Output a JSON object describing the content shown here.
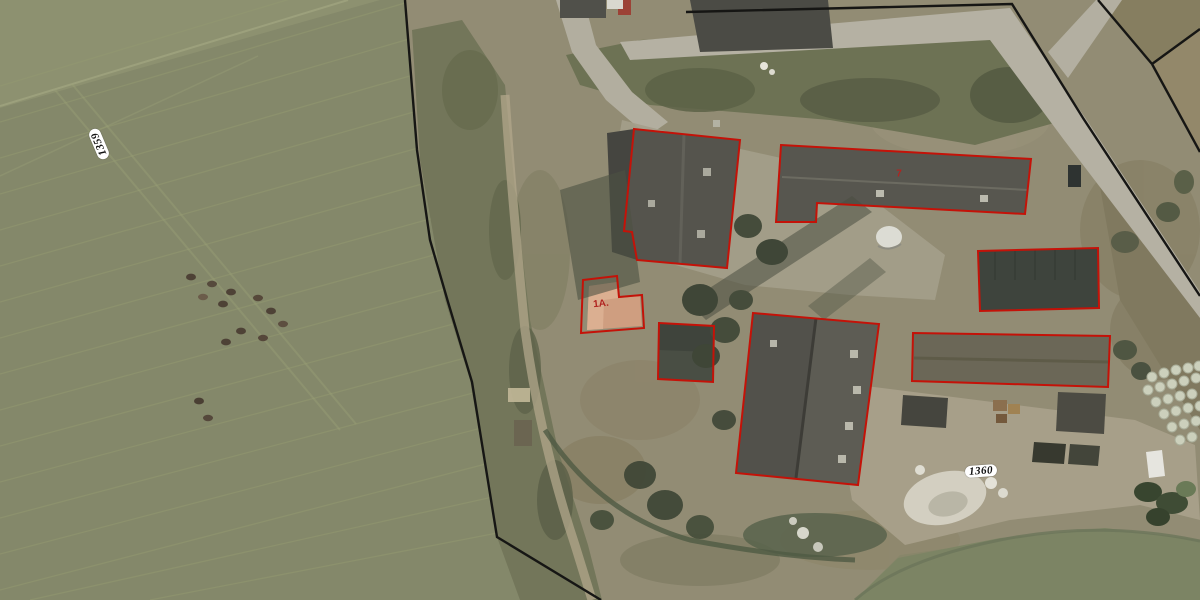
{
  "map": {
    "type": "aerial-cadastral-view",
    "labels": {
      "parcel_left": {
        "text": "1359",
        "x": 99,
        "y": 144,
        "rotation": -113
      },
      "parcel_right": {
        "text": "1360",
        "x": 981,
        "y": 471,
        "rotation": -4
      },
      "house_number_1a": {
        "text": "1A.",
        "x": 601,
        "y": 304,
        "rotation": -6
      },
      "house_number_7": {
        "text": "7",
        "x": 899,
        "y": 174,
        "rotation": 0
      }
    },
    "overlay": {
      "outline_color": "#c41208",
      "boundary_color": "#161614",
      "label_text_color": "#b02420",
      "boundary_lines": [
        {
          "name": "parcel-boundary-west",
          "points": [
            [
              405,
              0
            ],
            [
              417,
              150
            ],
            [
              430,
              240
            ],
            [
              448,
              302
            ],
            [
              472,
              382
            ],
            [
              497,
              537
            ],
            [
              601,
              600
            ]
          ]
        },
        {
          "name": "parcel-boundary-north-east",
          "points": [
            [
              686,
              12
            ],
            [
              1012,
              4
            ],
            [
              1083,
              118
            ],
            [
              1200,
              296
            ]
          ]
        },
        {
          "name": "neighbor-boundary-a",
          "points": [
            [
              1098,
              0
            ],
            [
              1152,
              64
            ]
          ]
        },
        {
          "name": "neighbor-boundary-b",
          "points": [
            [
              1152,
              64
            ],
            [
              1200,
              29
            ]
          ]
        },
        {
          "name": "neighbor-boundary-c",
          "points": [
            [
              1152,
              64
            ],
            [
              1200,
              152
            ]
          ]
        }
      ],
      "building_outlines": [
        {
          "id": "barn-north",
          "points": [
            [
              634,
              129
            ],
            [
              740,
              140
            ],
            [
              727,
              268
            ],
            [
              637,
              260
            ],
            [
              632,
              232
            ],
            [
              624,
              231
            ]
          ]
        },
        {
          "id": "stable-long-ne",
          "points": [
            [
              781,
              145
            ],
            [
              1031,
              159
            ],
            [
              1025,
              214
            ],
            [
              817,
              203
            ],
            [
              816,
              222
            ],
            [
              776,
              222
            ]
          ]
        },
        {
          "id": "shed-east",
          "points": [
            [
              978,
              251
            ],
            [
              1098,
              248
            ],
            [
              1099,
              308
            ],
            [
              980,
              311
            ]
          ]
        },
        {
          "id": "stable-long-se",
          "points": [
            [
              913,
              333
            ],
            [
              1110,
              336
            ],
            [
              1108,
              387
            ],
            [
              912,
              381
            ]
          ]
        },
        {
          "id": "barn-south",
          "points": [
            [
              753,
              313
            ],
            [
              879,
              324
            ],
            [
              858,
              485
            ],
            [
              736,
              473
            ]
          ]
        },
        {
          "id": "shed-center",
          "points": [
            [
              659,
              323
            ],
            [
              714,
              326
            ],
            [
              713,
              382
            ],
            [
              658,
              379
            ]
          ]
        },
        {
          "id": "house-1a",
          "points": [
            [
              583,
              280
            ],
            [
              617,
              276
            ],
            [
              619,
              297
            ],
            [
              642,
              295
            ],
            [
              644,
              328
            ],
            [
              581,
              333
            ]
          ]
        }
      ]
    },
    "colors": {
      "field_green": "#84886a",
      "farm_ground": "#928c74",
      "road_gray": "#b5b1a3",
      "roof_dark": "#504f48",
      "roof_salmon": "#cf9e80"
    }
  }
}
